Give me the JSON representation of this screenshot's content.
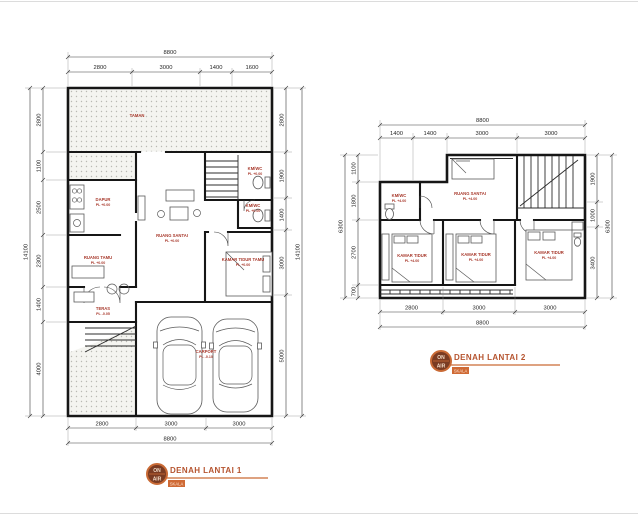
{
  "sheet": {
    "colors": {
      "wall": "#161616",
      "dimension_text": "#1f1f1f",
      "room_label_red": "#a8392c",
      "title_orange": "#b5532e",
      "logo_ring_orange": "#c96a35",
      "logo_fill_brown": "#7a3b22",
      "hatch_dot_gray": "#b9b9b3"
    }
  },
  "plan1": {
    "title": "DENAH LANTAI 1",
    "scale_label": "SKALA",
    "logo": {
      "top": "ON",
      "bottom": "AIR"
    },
    "dims": {
      "top_total": "8800",
      "top": [
        "2800",
        "3000",
        "1400",
        "1600"
      ],
      "bottom": [
        "2800",
        "3000",
        "3000"
      ],
      "bottom_total": "8800",
      "left": [
        "2800",
        "1100",
        "2500",
        "2300",
        "1400",
        "4000"
      ],
      "left_total": "14100",
      "right": [
        "2800",
        "1900",
        "1400",
        "3000",
        "5000"
      ],
      "right_total": "14100"
    },
    "rooms": {
      "taman": {
        "name": "TAMAN"
      },
      "dapur": {
        "name": "DAPUR",
        "level": "PL +0.00"
      },
      "ruang_santai": {
        "name": "RUANG SANTAI",
        "level": "PL +0.00"
      },
      "ruang_tamu": {
        "name": "RUANG TAMU",
        "level": "PL +0.00"
      },
      "kamar_tidur_tamu": {
        "name": "KAMAR TIDUR TAMU",
        "level": "PL +0.00"
      },
      "kmwc_1": {
        "name": "KM/WC",
        "level": "PL +0.00"
      },
      "kmwc_2": {
        "name": "KM/WC",
        "level": "PL +0.00"
      },
      "teras": {
        "name": "TERAS",
        "level": "PL -0.05"
      },
      "carport": {
        "name": "CARPORT",
        "level": "PL -0.10"
      }
    }
  },
  "plan2": {
    "title": "DENAH LANTAI 2",
    "scale_label": "SKALA",
    "logo": {
      "top": "ON",
      "bottom": "AIR"
    },
    "dims": {
      "top_total": "8800",
      "top": [
        "1400",
        "1400",
        "3000",
        "3000"
      ],
      "bottom": [
        "2800",
        "3000",
        "3000"
      ],
      "bottom_total": "8800",
      "left": [
        "1100",
        "1800",
        "2700",
        "700"
      ],
      "left_total": "6300",
      "right": [
        "1900",
        "1000",
        "3400"
      ],
      "right_total": "6300"
    },
    "rooms": {
      "ruang_santai": {
        "name": "RUANG SANTAI",
        "level": "PL +4.00"
      },
      "kmwc": {
        "name": "KM/WC",
        "level": "PL +4.00"
      },
      "kamar_tidur_1": {
        "name": "KAMAR TIDUR",
        "level": "PL +4.00"
      },
      "kamar_tidur_2": {
        "name": "KAMAR TIDUR",
        "level": "PL +4.00"
      },
      "kamar_tidur_3": {
        "name": "KAMAR TIDUR",
        "level": "PL +4.00"
      }
    }
  }
}
